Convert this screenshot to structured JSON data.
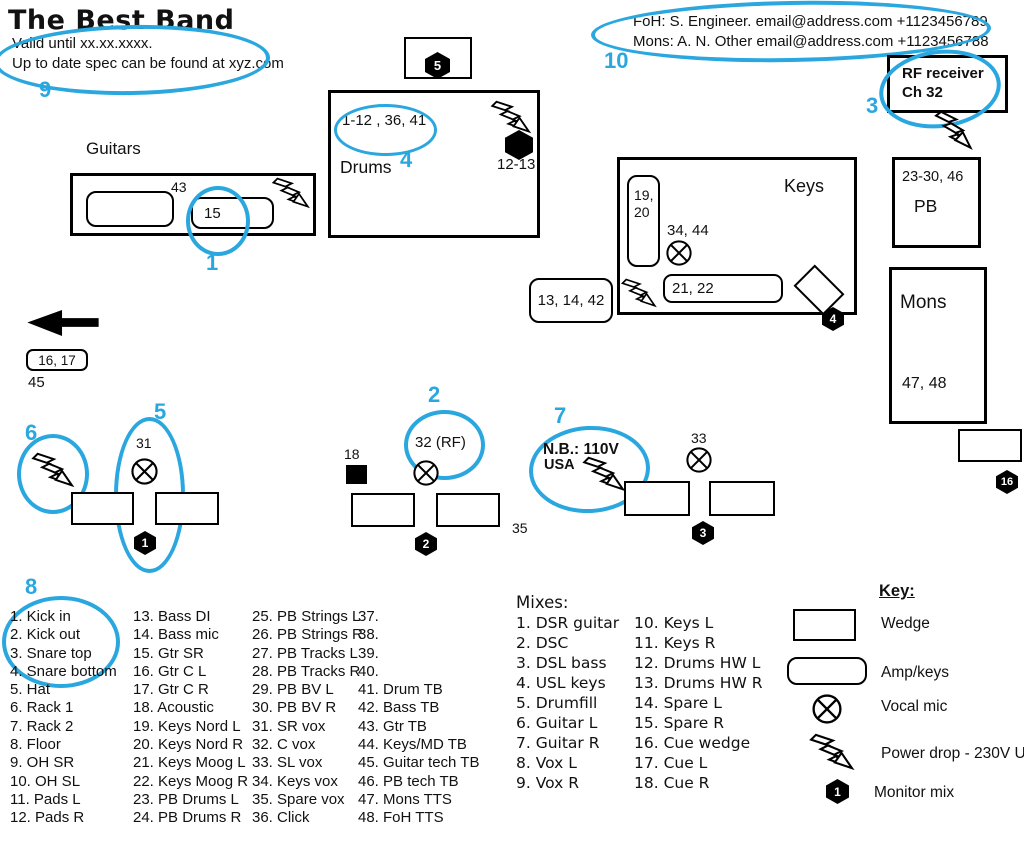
{
  "accent_blue": "#2aa7de",
  "header": {
    "title": "The Best Band",
    "valid_line1": "Valid until xx.xx.xxxx.",
    "valid_line2": "Up to date spec can be found at xyz.com",
    "foh_contact": "FoH: S. Engineer. email@address.com +1123456789",
    "mons_contact": "Mons: A. N. Other email@address.com +1123456788"
  },
  "callouts": {
    "c1": "1",
    "c2": "2",
    "c3": "3",
    "c4": "4",
    "c5": "5",
    "c6": "6",
    "c7": "7",
    "c8": "8",
    "c9": "9",
    "c10": "10"
  },
  "stage": {
    "rf_receiver": {
      "line1": "RF receiver",
      "line2": "Ch 32"
    },
    "guitars": {
      "label": "Guitars",
      "amp1_tb": "43",
      "amp2_channel": "15"
    },
    "drums": {
      "label": "Drums",
      "channels": "1-12 , 36, 41",
      "drumfill_mix": "5",
      "hw_mixes": "12-13"
    },
    "keys": {
      "label": "Keys",
      "nord_line1": "19,",
      "nord_line2": "20",
      "vox_channels": "34, 44",
      "moog_channels": "21, 22",
      "mix": "4"
    },
    "bass": {
      "channels": "13, 14, 42"
    },
    "playback": {
      "channels": "23-30, 46",
      "label": "PB"
    },
    "mons_desk": {
      "label": "Mons",
      "channels": "47, 48",
      "cue_mix": "16"
    },
    "side_left": {
      "channels": "16, 17",
      "tb": "45"
    },
    "pos1": {
      "vox": "31",
      "mix": "1"
    },
    "pos2": {
      "vox": "32 (RF)",
      "acoustic": "18",
      "mix": "2",
      "spare_vox": "35"
    },
    "pos3": {
      "vox": "33",
      "nb_line1": "N.B.: 110V",
      "nb_line2": "USA",
      "mix": "3"
    }
  },
  "channel_list": {
    "col1": [
      "1. Kick in",
      "2. Kick out",
      "3. Snare top",
      "4. Snare bottom",
      "5. Hat",
      "6. Rack 1",
      "7. Rack 2",
      "8. Floor",
      "9. OH SR",
      "10. OH SL",
      "11. Pads L",
      "12. Pads R"
    ],
    "col2": [
      "13. Bass DI",
      "14. Bass mic",
      "15. Gtr SR",
      "16. Gtr C L",
      "17. Gtr C R",
      "18. Acoustic",
      "19. Keys Nord L",
      "20. Keys Nord R",
      "21. Keys Moog L",
      "22. Keys Moog R",
      "23. PB Drums L",
      "24. PB Drums R"
    ],
    "col3": [
      "25. PB Strings L",
      "26. PB Strings R",
      "27. PB Tracks L",
      "28. PB Tracks R",
      "29. PB BV L",
      "30. PB BV R",
      "31. SR vox",
      "32. C vox",
      "33. SL vox",
      "34. Keys vox",
      "35. Spare vox",
      "36. Click"
    ],
    "col4": [
      "37.",
      "38.",
      "39.",
      "40.",
      "41. Drum TB",
      "42. Bass TB",
      "43. Gtr TB",
      "44. Keys/MD TB",
      "45. Guitar tech TB",
      "46. PB tech TB",
      "47. Mons TTS",
      "48. FoH TTS"
    ]
  },
  "mixes": {
    "title": "Mixes:",
    "col1": [
      "1. DSR guitar",
      "2. DSC",
      "3. DSL bass",
      "4. USL keys",
      "5. Drumfill",
      "6. Guitar L",
      "7. Guitar R",
      "8. Vox L",
      "9. Vox R"
    ],
    "col2": [
      "10. Keys L",
      "11. Keys R",
      "12. Drums HW L",
      "13. Drums HW R",
      "14. Spare L",
      "15. Spare R",
      "16. Cue wedge",
      "17. Cue L",
      "18. Cue R"
    ]
  },
  "legend": {
    "title": "Key:",
    "wedge": "Wedge",
    "amp": "Amp/keys",
    "vocal_mic": "Vocal mic",
    "power": "Power drop - 230V UK",
    "monitor": "Monitor mix",
    "monitor_number": "1"
  }
}
